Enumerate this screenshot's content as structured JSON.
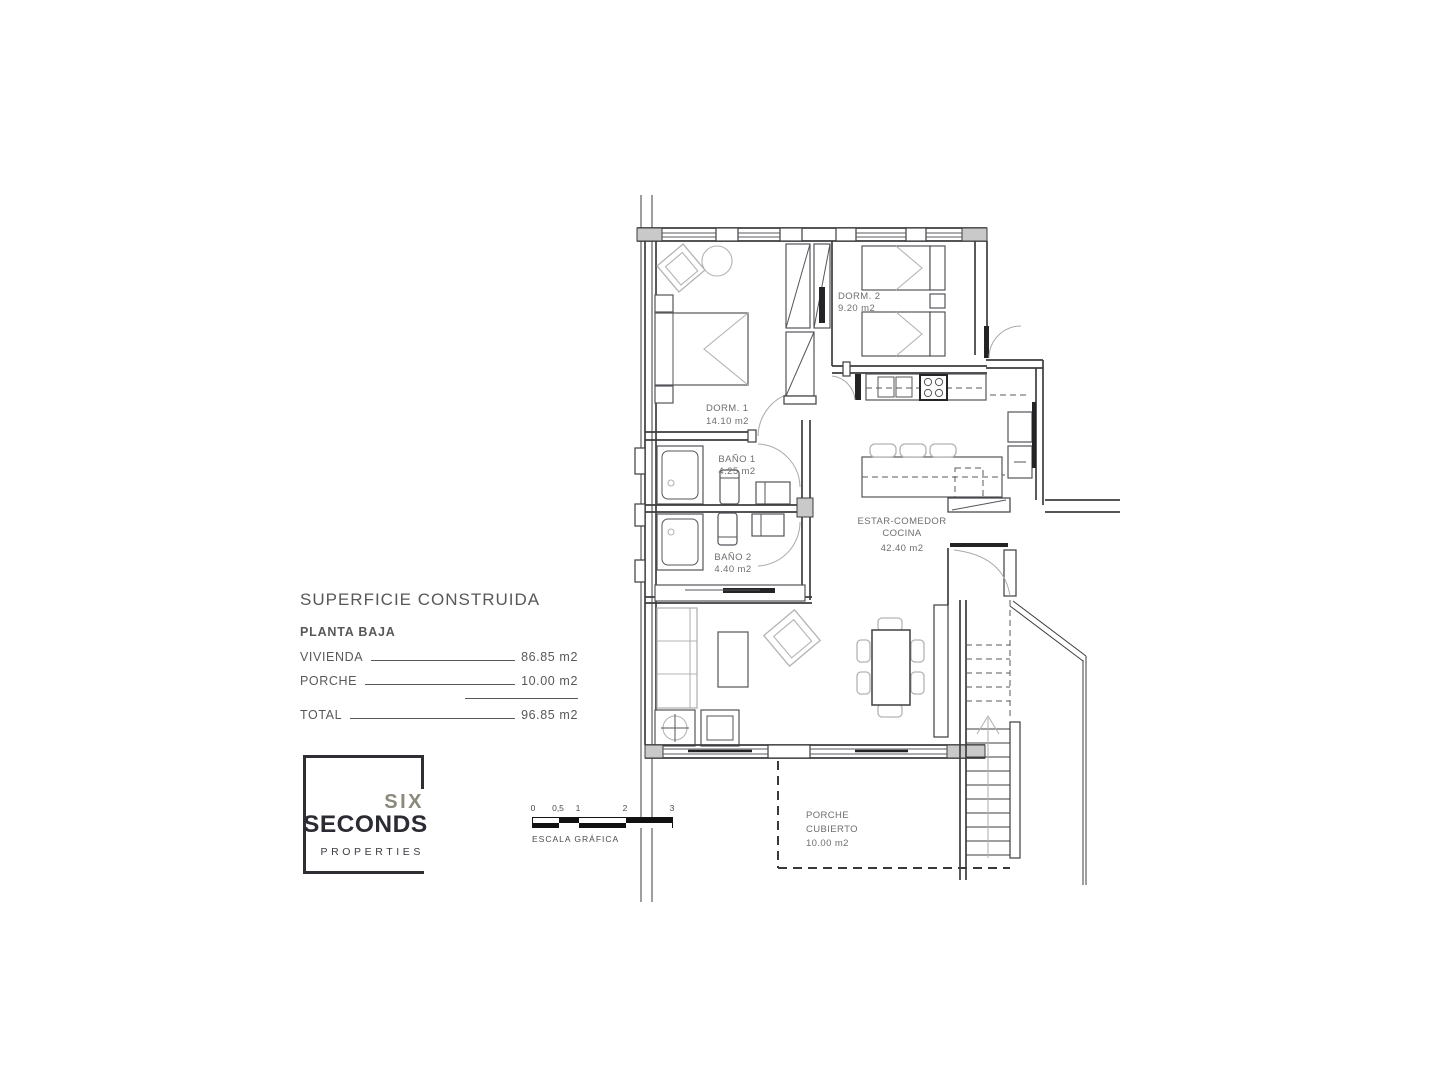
{
  "summary": {
    "title": "SUPERFICIE CONSTRUIDA",
    "floor": "PLANTA BAJA",
    "rows": [
      {
        "label": "VIVIENDA",
        "value": "86.85 m2"
      },
      {
        "label": "PORCHE",
        "value": "10.00 m2"
      }
    ],
    "total_label": "TOTAL",
    "total_value": "96.85 m2"
  },
  "logo": {
    "line1": "SIX",
    "line2": "SECONDS",
    "line3": "PROPERTIES",
    "accent_color": "#8c887c",
    "dark_color": "#2b2b33"
  },
  "scale_bar": {
    "ticks": [
      "0",
      "0,5",
      "1",
      "2",
      "3"
    ],
    "caption": "ESCALA GRÁFICA"
  },
  "floor_plan": {
    "line_color": "#3d3d3f",
    "rooms": [
      {
        "id": "dorm1",
        "name": "DORM. 1",
        "area": "14.10 m2"
      },
      {
        "id": "dorm2",
        "name": "DORM. 2",
        "area": "9.20 m2"
      },
      {
        "id": "bano1",
        "name": "BAÑO 1",
        "area": "4.25 m2"
      },
      {
        "id": "bano2",
        "name": "BAÑO 2",
        "area": "4.40 m2"
      },
      {
        "id": "estar",
        "name": "ESTAR-COMEDOR",
        "name2": "COCINA",
        "area": "42.40 m2"
      },
      {
        "id": "porche",
        "name": "PORCHE",
        "name2": "CUBIERTO",
        "area": "10.00 m2"
      }
    ]
  }
}
